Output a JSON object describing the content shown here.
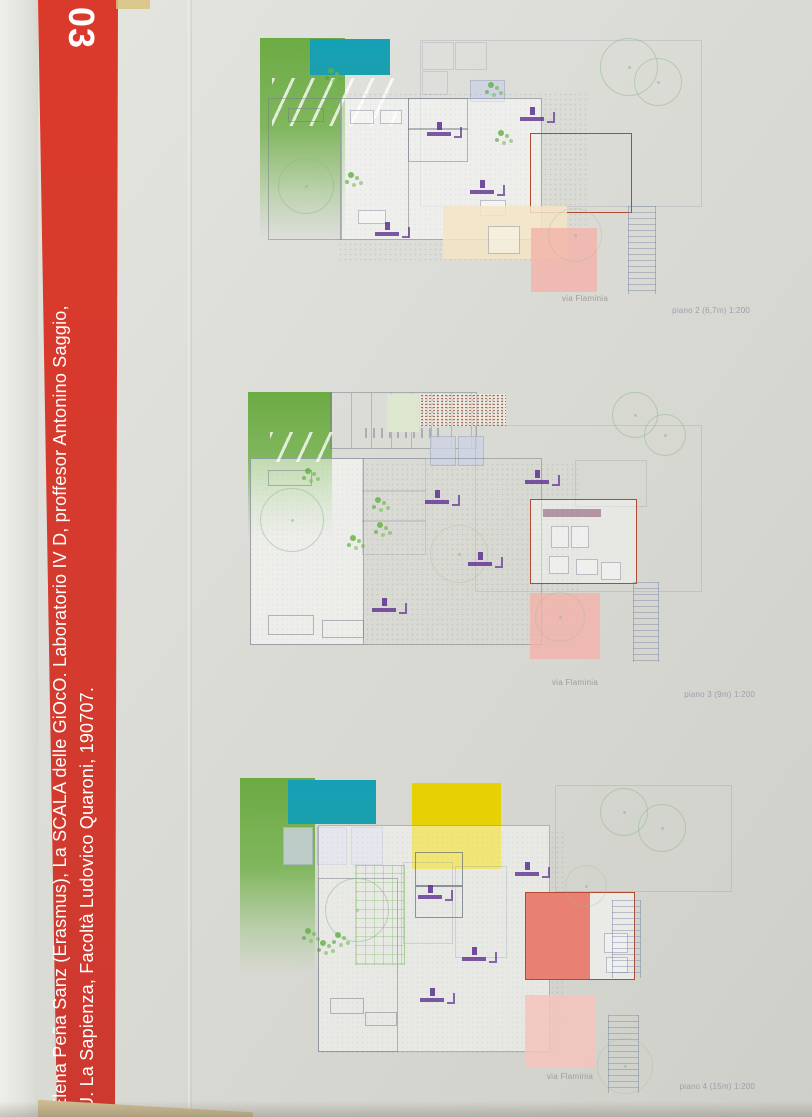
{
  "banner": {
    "sheet_number": "03",
    "line1": "Elena Peña Sanz (Erasmus), La SCALA delle GiOcO. Laboratorio IV D, proffesor Antonino Saggio,",
    "line2": "U. La Sapienza, Facoltà Ludovico Quaroni, 190707.",
    "background_color": "#d53a2e",
    "text_color": "#ffffff"
  },
  "plans": [
    {
      "street_label": "via Flaminia",
      "caption": "piano 2 (6,7m) 1:200"
    },
    {
      "street_label": "via Flaminia",
      "caption": "piano 3 (9m) 1:200"
    },
    {
      "street_label": "via Flaminia",
      "caption": "piano 4 (15m) 1:200"
    }
  ],
  "palette": {
    "paper": "#dcdcd6",
    "pool_teal": "#17a2b5",
    "lawn_green": "#67a83e",
    "pale_green": "#dde6cf",
    "rust_brown": "#9a5c42",
    "yellow": "#e5d104",
    "salmon_fill": "#e88173",
    "pink_light": "#f2bcb2",
    "cream": "#f3e4c6",
    "plan_red_outline": "#b04a31",
    "marker_purple": "#5c2f91",
    "caption_gray": "#9aa0aa"
  },
  "icons": {
    "tree": "green-outline-circle",
    "stairs": "ladder-lines",
    "lift_marker": "purple-stair-lift-glyph",
    "plant": "green-dot-cluster"
  }
}
